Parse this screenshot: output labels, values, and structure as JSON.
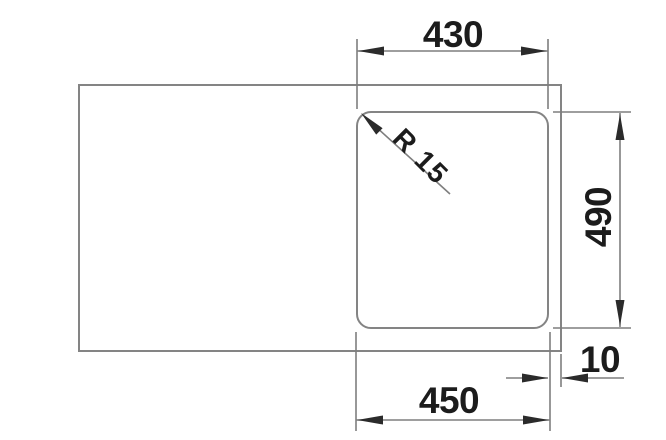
{
  "drawing": {
    "labels": {
      "width_top": "430",
      "depth": "490",
      "width_bottom": "450",
      "edge_offset": "10",
      "corner_radius": "R 15"
    },
    "colors": {
      "background": "#ffffff",
      "outline": "#848484",
      "dimension_line": "#7e7e7e",
      "arrow": "#2b2b2b",
      "label_text": "#1c1c1c"
    }
  }
}
